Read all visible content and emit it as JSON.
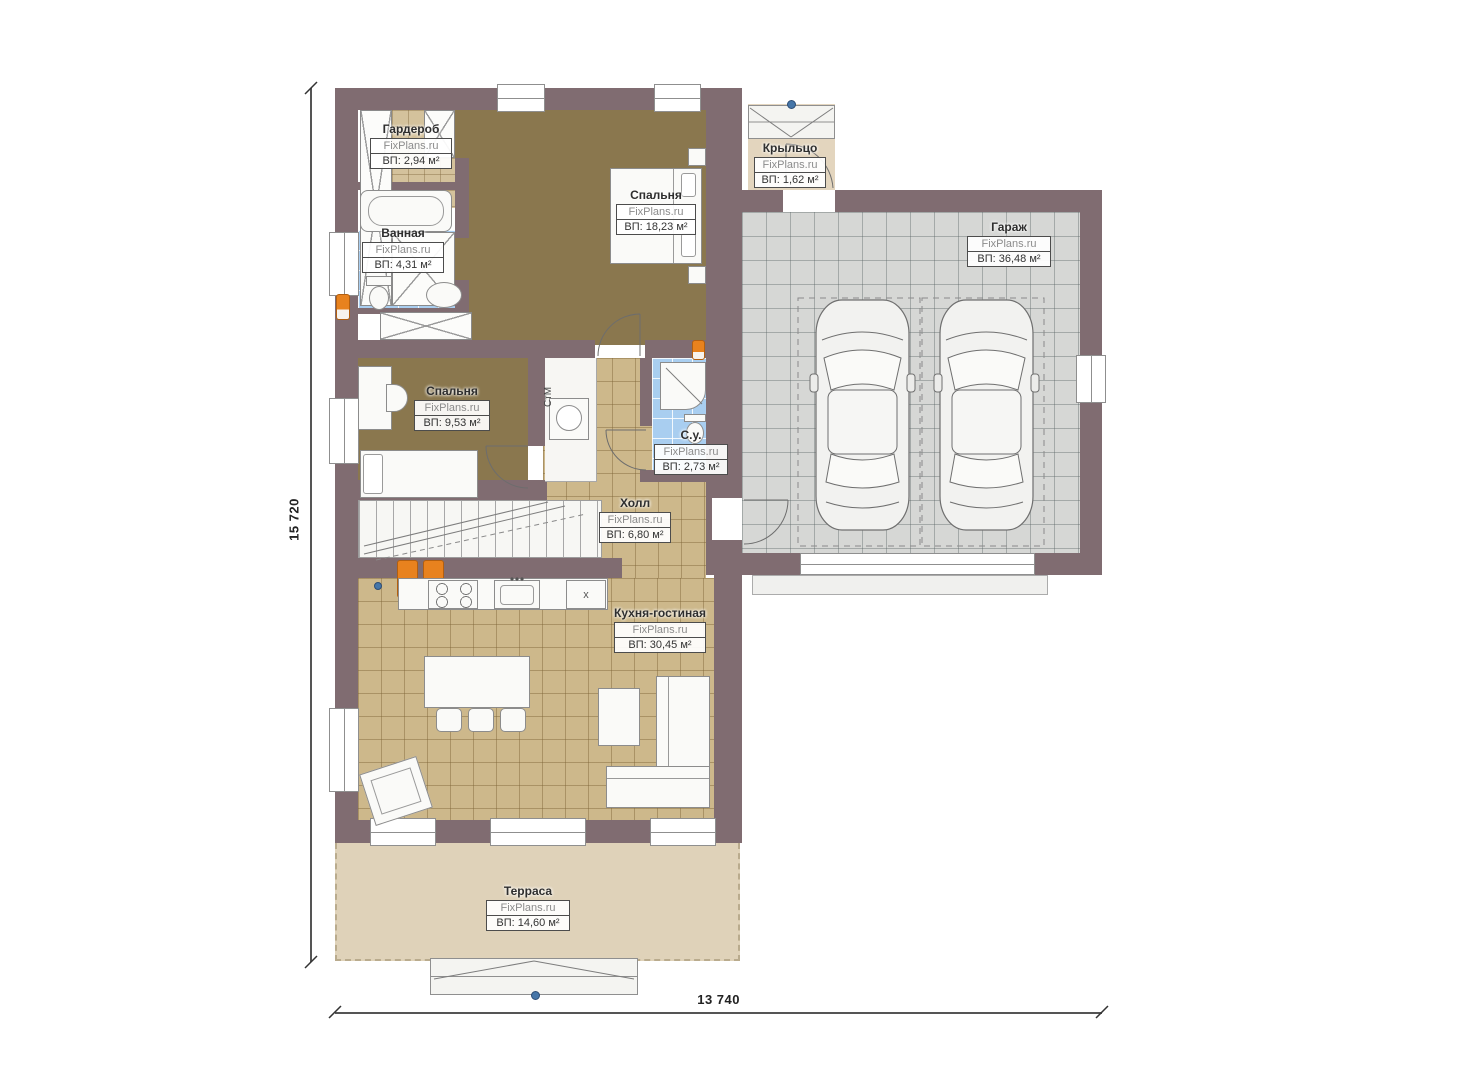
{
  "plan": {
    "dimensions": {
      "height_label": "15 720",
      "width_label": "13 740"
    },
    "rooms": [
      {
        "name": "Гардероб",
        "brand": "FixPlans.ru",
        "area": "ВП: 2,94 м²"
      },
      {
        "name": "Ванная",
        "brand": "FixPlans.ru",
        "area": "ВП: 4,31 м²"
      },
      {
        "name": "Спальня",
        "brand": "FixPlans.ru",
        "area": "ВП: 18,23 м²"
      },
      {
        "name": "Крыльцо",
        "brand": "FixPlans.ru",
        "area": "ВП: 1,62 м²"
      },
      {
        "name": "Гараж",
        "brand": "FixPlans.ru",
        "area": "ВП: 36,48 м²"
      },
      {
        "name": "Спальня",
        "brand": "FixPlans.ru",
        "area": "ВП: 9,53 м²"
      },
      {
        "name": "С.у.",
        "brand": "FixPlans.ru",
        "area": "ВП: 2,73 м²"
      },
      {
        "name": "Холл",
        "brand": "FixPlans.ru",
        "area": "ВП: 6,80 м²"
      },
      {
        "name": "Кухня-гостиная",
        "brand": "FixPlans.ru",
        "area": "ВП: 30,45 м²"
      },
      {
        "name": "Терраса",
        "brand": "FixPlans.ru",
        "area": "ВП: 14,60 м²"
      }
    ],
    "annotations": {
      "washing_machine": "СтМ",
      "kitchen_unit_mark": "x"
    },
    "colors": {
      "wall": "#806C71",
      "bedroom_floor": "#8A774E",
      "tile_tan": "#CDB88B",
      "tile_gray": "#D6D7D5",
      "tile_blue": "#A9CEF0",
      "terrace": "#DFD2B9",
      "porch": "#E3D5BE",
      "radiator_orange": "#E8821E",
      "marker_blue": "#4676A8"
    }
  }
}
